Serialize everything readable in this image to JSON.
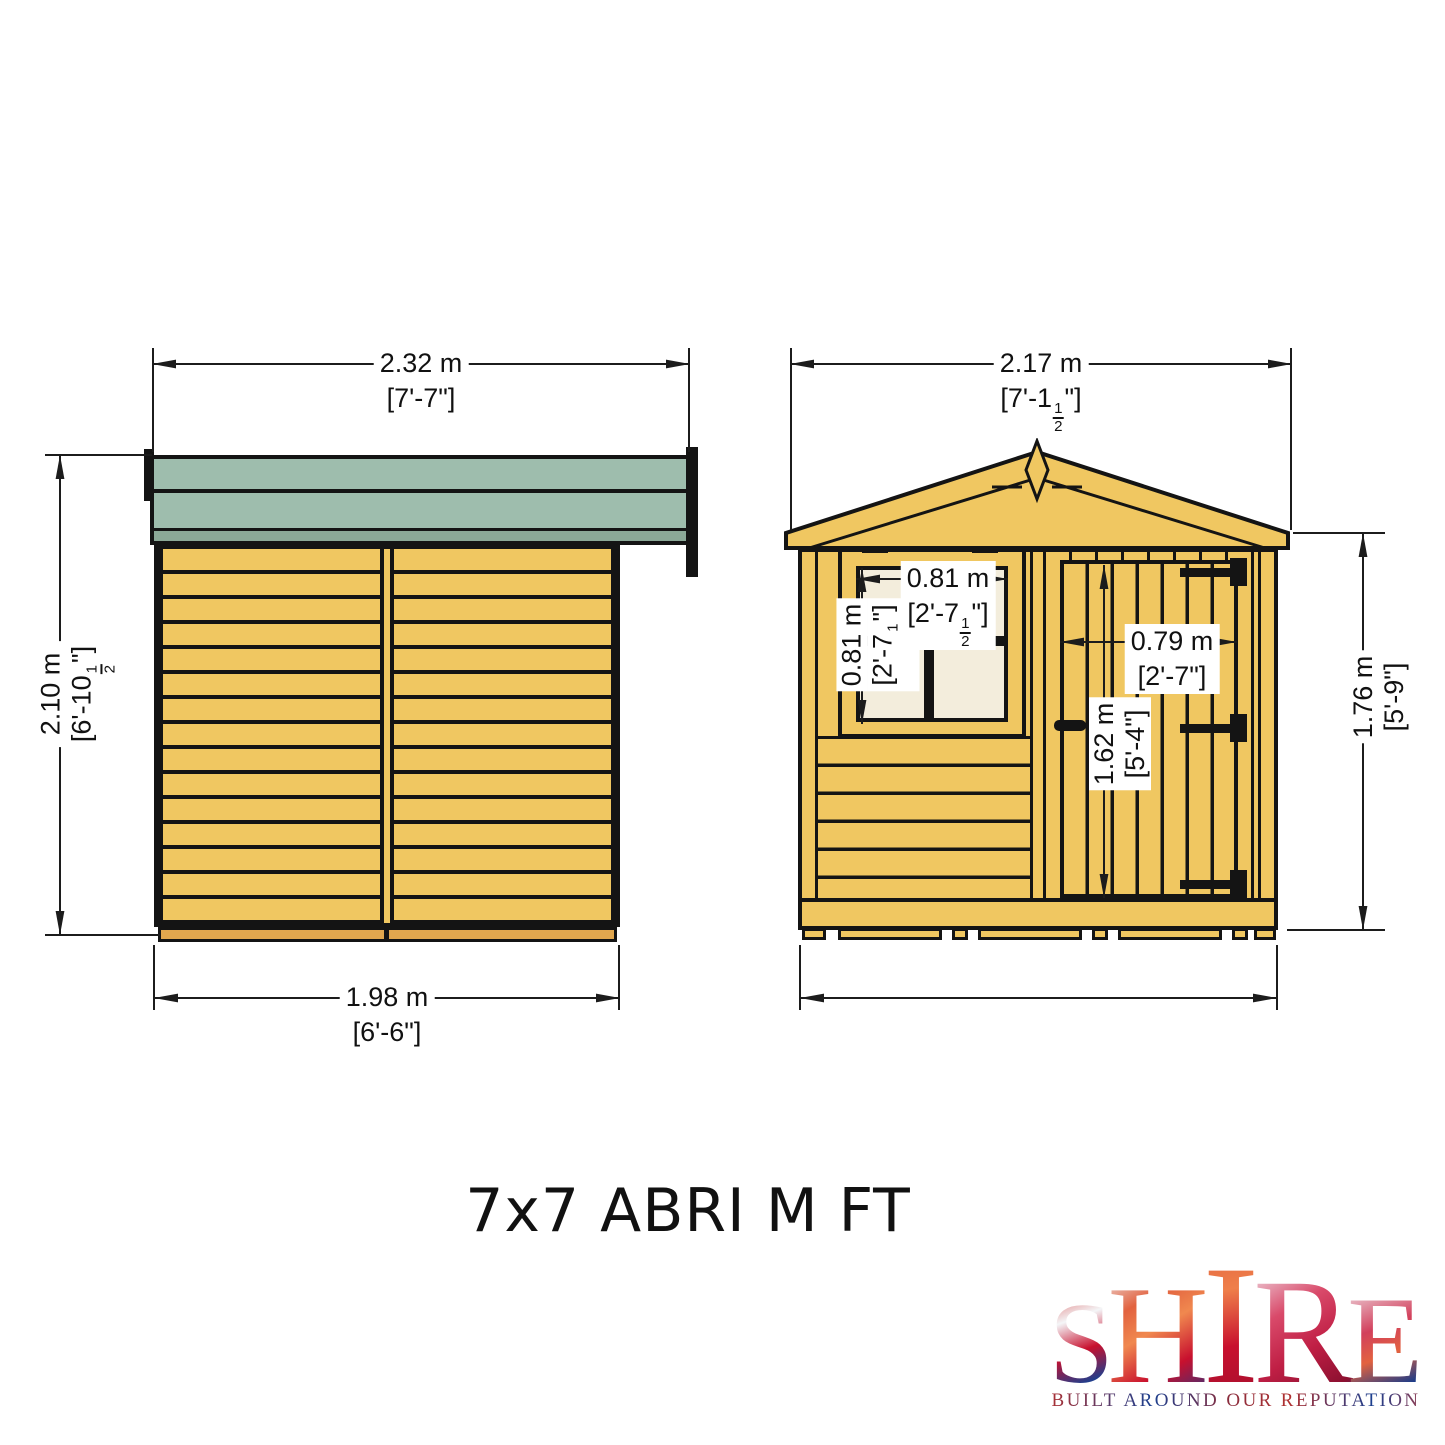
{
  "title": "7x7 ABRI M FT",
  "views": {
    "side": {
      "label": "side elevation",
      "dims": {
        "roof_width": {
          "m": "2.32 m",
          "ft": "[7'-7\"]"
        },
        "height": {
          "m": "2.10 m",
          "ft": "[6'-10½\"]"
        },
        "base_width": {
          "m": "1.98 m",
          "ft": "[6'-6\"]"
        }
      }
    },
    "front": {
      "label": "front elevation",
      "dims": {
        "roof_width": {
          "m": "2.17 m",
          "ft": "[7'-1½\"]"
        },
        "window_width": {
          "m": "0.81 m",
          "ft": "[2'-7½\"]"
        },
        "window_height": {
          "m": "0.81 m",
          "ft": "[2'-7½\"]"
        },
        "door_width": {
          "m": "0.79 m",
          "ft": "[2'-7\"]"
        },
        "door_height": {
          "m": "1.62 m",
          "ft": "[5'-4\"]"
        },
        "eaves_height": {
          "m": "1.76 m",
          "ft": "[5'-9\"]"
        }
      }
    }
  },
  "logo": {
    "word": "SHIRE",
    "tagline": "BUILT AROUND OUR REPUTATION"
  },
  "colors": {
    "wood": "#f0c761",
    "wood_dark": "#e2a74e",
    "roof": "#9ebdad",
    "roof_dark": "#8ba897",
    "glass": "#f3eddc",
    "line": "#141414"
  }
}
